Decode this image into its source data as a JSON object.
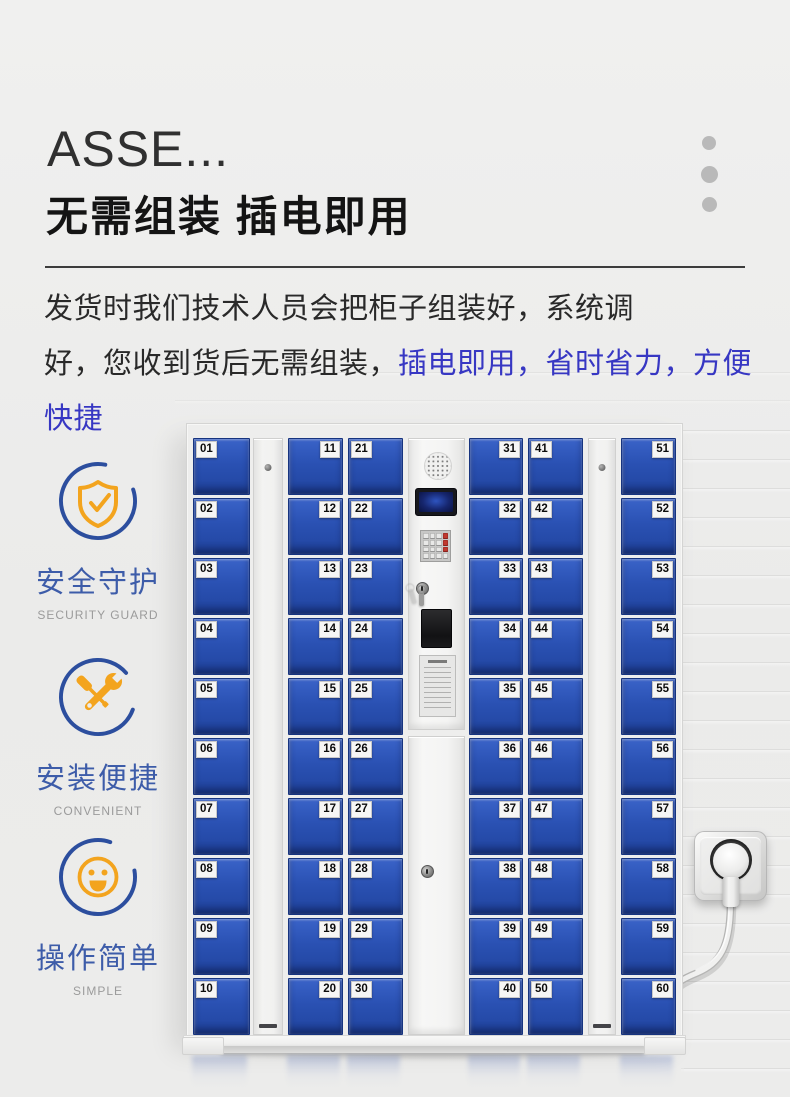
{
  "header": {
    "title_truncated": "ASSE...",
    "headline": "无需组装  插电即用"
  },
  "intro": {
    "line1": "发货时我们技术人员会把柜子组装好，系统调",
    "line2_black": "好，您收到货后无需组装，",
    "line2_blue": "插电即用，省时省力，方便快捷"
  },
  "features": [
    {
      "icon": "shield-check-icon",
      "title": "安全守护",
      "subtitle": "SECURITY GUARD"
    },
    {
      "icon": "wrench-screwdriver-icon",
      "title": "安装便捷",
      "subtitle": "CONVENIENT"
    },
    {
      "icon": "smiley-face-icon",
      "title": "操作简单",
      "subtitle": "SIMPLE"
    }
  ],
  "cabinet": {
    "label_sides": [
      "left",
      "right",
      "left",
      "right",
      "left",
      "right"
    ],
    "door_numbers": [
      [
        "01",
        "02",
        "03",
        "04",
        "05",
        "06",
        "07",
        "08",
        "09",
        "10"
      ],
      [
        "11",
        "12",
        "13",
        "14",
        "15",
        "16",
        "17",
        "18",
        "19",
        "20"
      ],
      [
        "21",
        "22",
        "23",
        "24",
        "25",
        "26",
        "27",
        "28",
        "29",
        "30"
      ],
      [
        "31",
        "32",
        "33",
        "34",
        "35",
        "36",
        "37",
        "38",
        "39",
        "40"
      ],
      [
        "41",
        "42",
        "43",
        "44",
        "45",
        "46",
        "47",
        "48",
        "49",
        "50"
      ],
      [
        "51",
        "52",
        "53",
        "54",
        "55",
        "56",
        "57",
        "58",
        "59",
        "60"
      ]
    ]
  },
  "colors": {
    "highlight_text_blue": "#3737c3",
    "feature_title_blue": "#3d5ca9",
    "icon_ring_blue": "#2c4e9e",
    "icon_orange": "#f3a41e",
    "door_blue": "#2a51b3",
    "decor_dot_gray": "#b9b9b9"
  }
}
